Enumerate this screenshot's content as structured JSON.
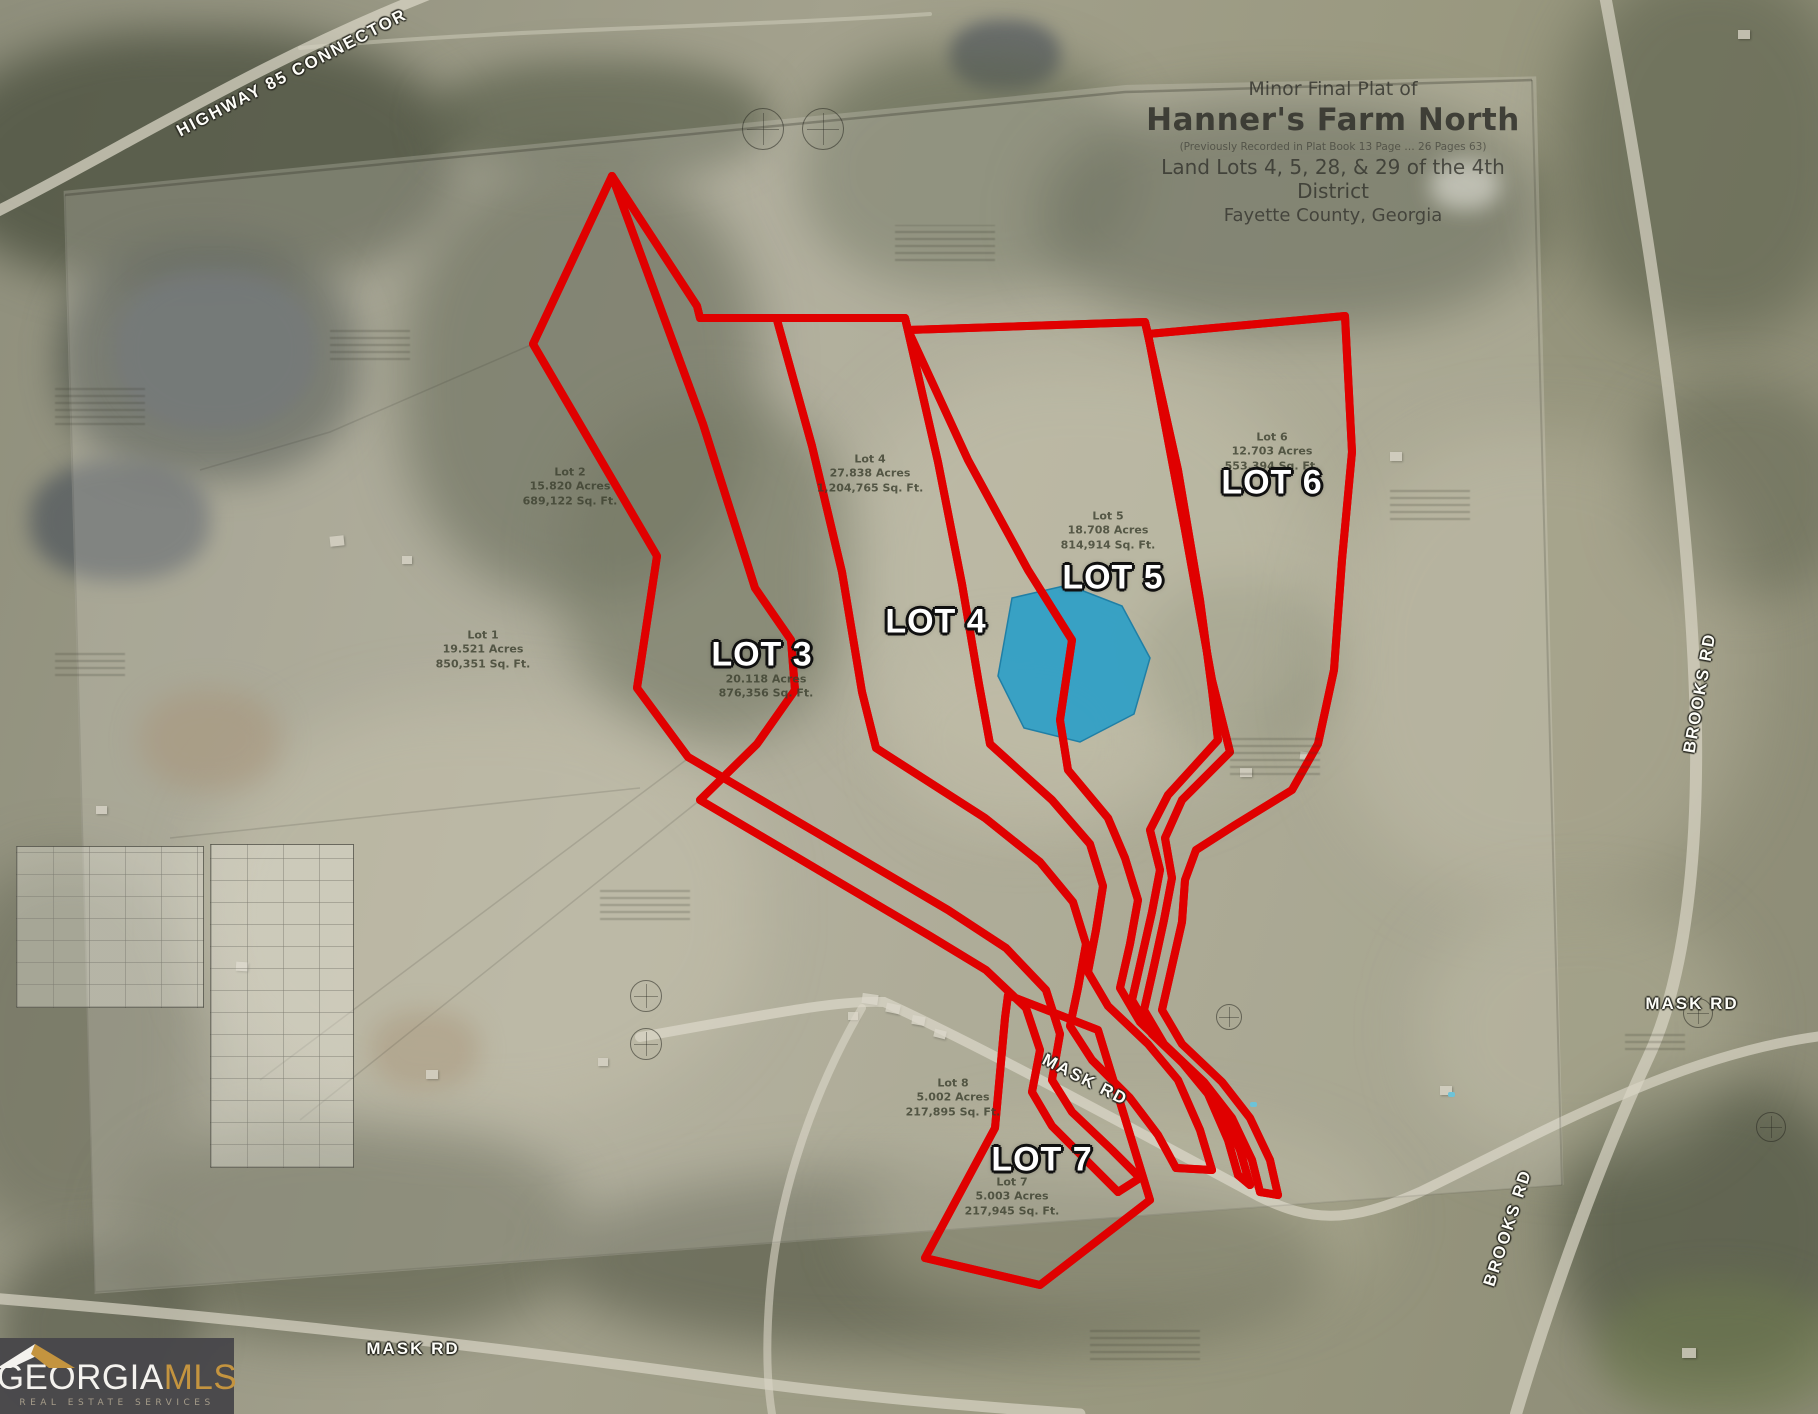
{
  "title_block": {
    "line1": "Minor Final Plat of",
    "line2": "Hanner's Farm North",
    "line3": "(Previously Recorded in Plat Book 13 Page … 26 Pages 63)",
    "line4": "Land Lots 4, 5, 28, & 29 of the 4th District",
    "line5": "Fayette County, Georgia"
  },
  "overlay_labels": {
    "lot3": "LOT 3",
    "lot4": "LOT 4",
    "lot5": "LOT 5",
    "lot6": "LOT 6",
    "lot7": "LOT 7"
  },
  "road_labels": {
    "highway85": "HIGHWAY 85 CONNECTOR",
    "brooks": "BROOKS RD",
    "mask": "MASK RD"
  },
  "plat_lots": {
    "lot1": {
      "name": "Lot 1",
      "acres": "19.521 Acres",
      "sqft": "850,351 Sq. Ft."
    },
    "lot2": {
      "name": "Lot 2",
      "acres": "15.820 Acres",
      "sqft": "689,122 Sq. Ft."
    },
    "lot3": {
      "name": "Lot 3",
      "acres": "20.118 Acres",
      "sqft": "876,356 Sq. Ft."
    },
    "lot4": {
      "name": "Lot 4",
      "acres": "27.838 Acres",
      "sqft": "1,204,765 Sq. Ft."
    },
    "lot5": {
      "name": "Lot 5",
      "acres": "18.708 Acres",
      "sqft": "814,914 Sq. Ft."
    },
    "lot6": {
      "name": "Lot 6",
      "acres": "12.703 Acres",
      "sqft": "553,394 Sq. Ft."
    },
    "lot8": {
      "name": "Lot 8",
      "acres": "5.002 Acres",
      "sqft": "217,895 Sq. Ft."
    },
    "lot7": {
      "name": "Lot 7",
      "acres": "5.003 Acres",
      "sqft": "217,945 Sq. Ft."
    }
  },
  "logo": {
    "part1": "GEORGIA",
    "part2": "MLS",
    "tagline": "REAL ESTATE SERVICES"
  },
  "colors": {
    "lot_outline_red": "#e00000",
    "lot_outline_core": "#ff6a6a",
    "pond_highlight_blue": "#2e9fc6",
    "logo_background": "#49484a",
    "logo_gold": "#c4943f"
  }
}
